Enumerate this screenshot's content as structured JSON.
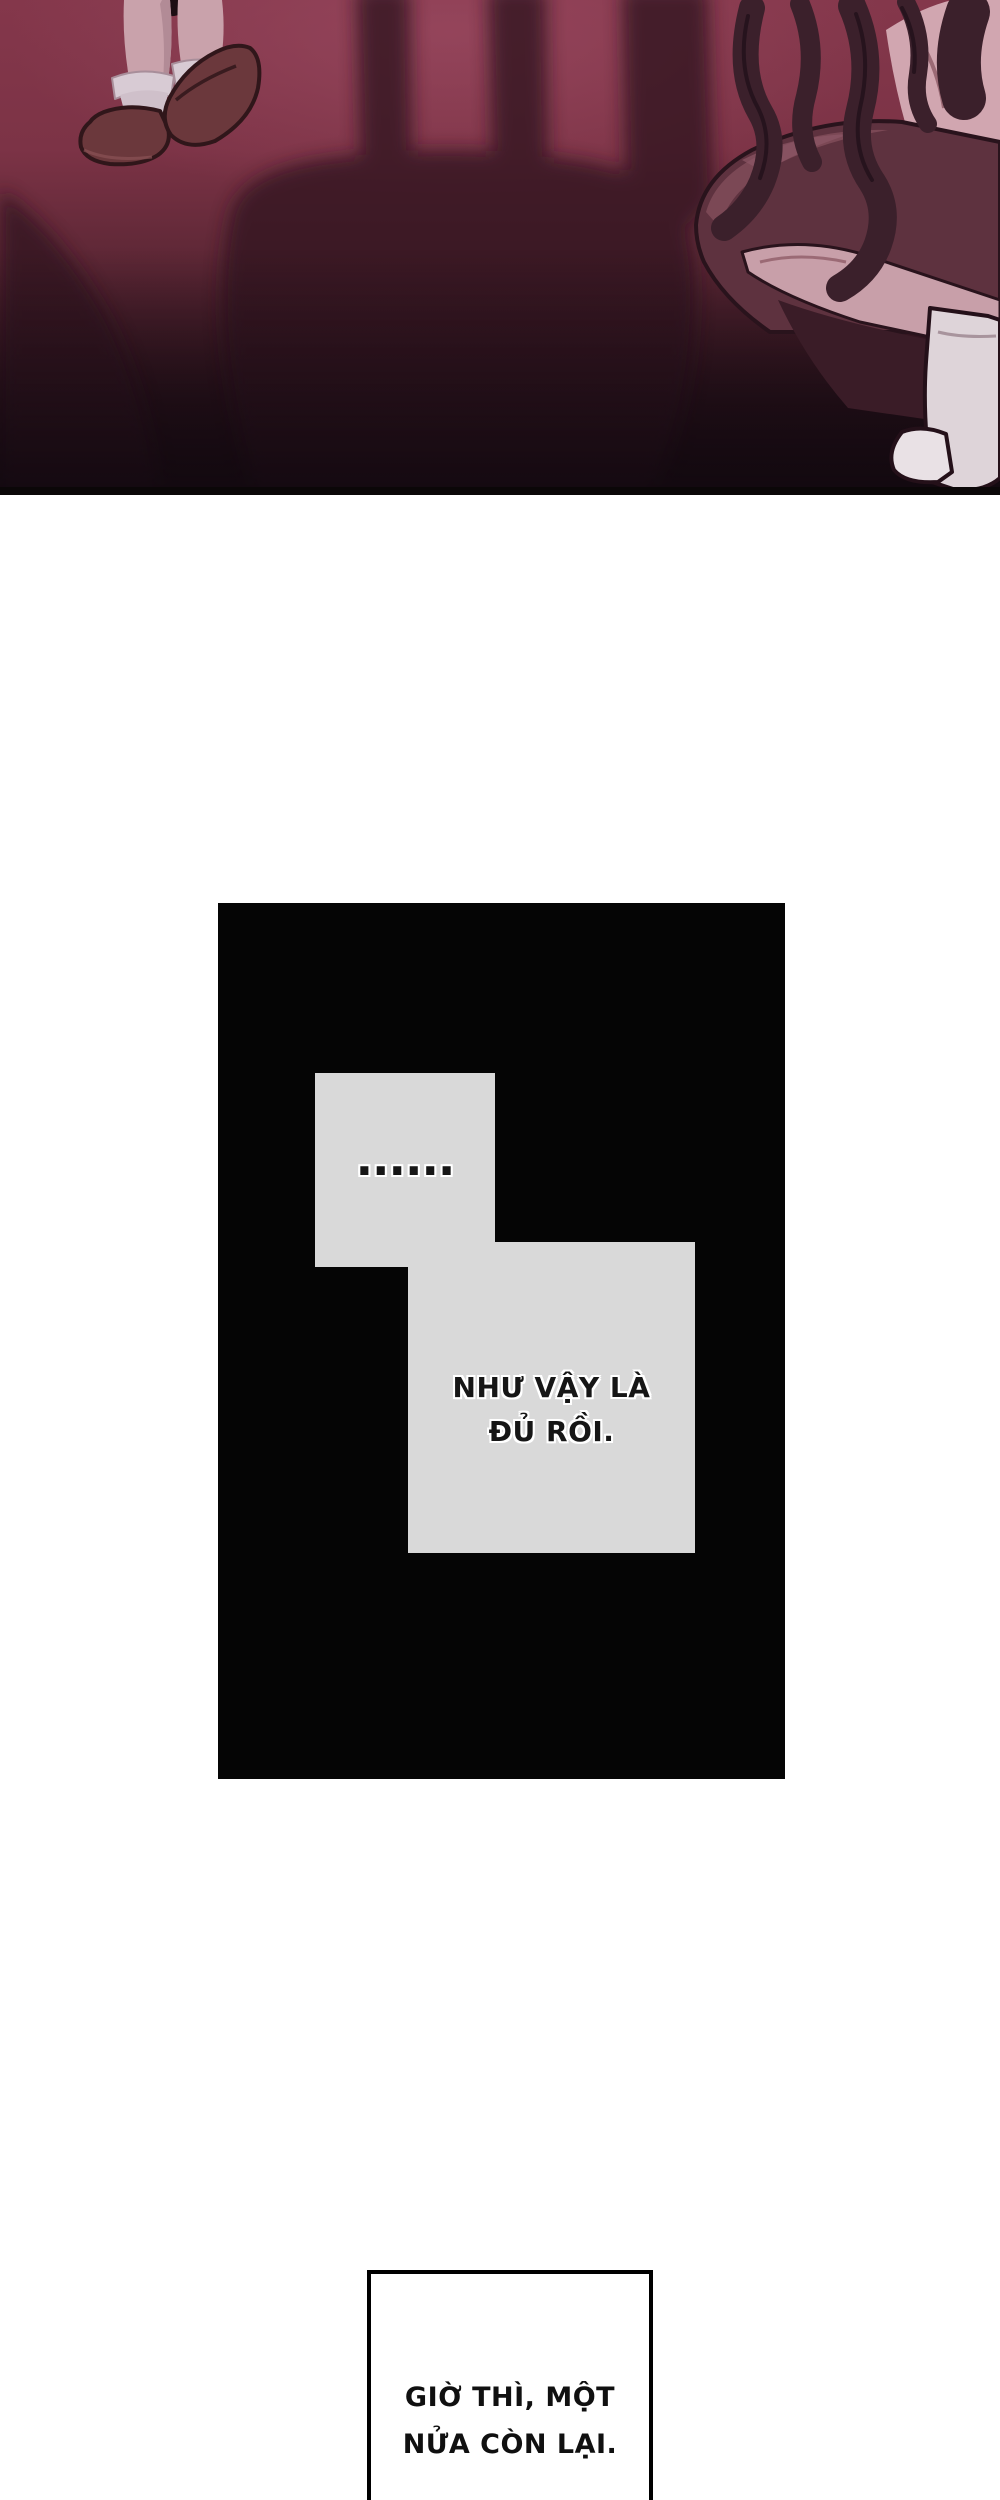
{
  "page": {
    "background": "#ffffff"
  },
  "art_panel": {
    "palette": {
      "bg_top": "#84374b",
      "bg_glow": "#a04e66",
      "bg_bottom": "#1b0c11",
      "shadow": "#361722",
      "skin": "#c9a2ab",
      "sock": "#d8cbd4",
      "shoe": "#6b383c",
      "hair": "#3b202b",
      "garment": "#5e323f",
      "garment_highlight": "#7e4a58",
      "belt": "#4b2632",
      "boot": "#ded4d9"
    }
  },
  "story_panel": {
    "background": "#050505",
    "bubble_color": "#d9d9d9",
    "ellipsis_bubble": {
      "text": "......"
    },
    "speech_bubble": {
      "lines": [
        "NHƯ VẬY LÀ",
        "ĐỦ RỒI."
      ]
    }
  },
  "caption_box": {
    "border_color": "#000000",
    "lines": [
      "GIỜ THÌ, MỘT",
      "NỬA CÒN LẠI."
    ]
  }
}
